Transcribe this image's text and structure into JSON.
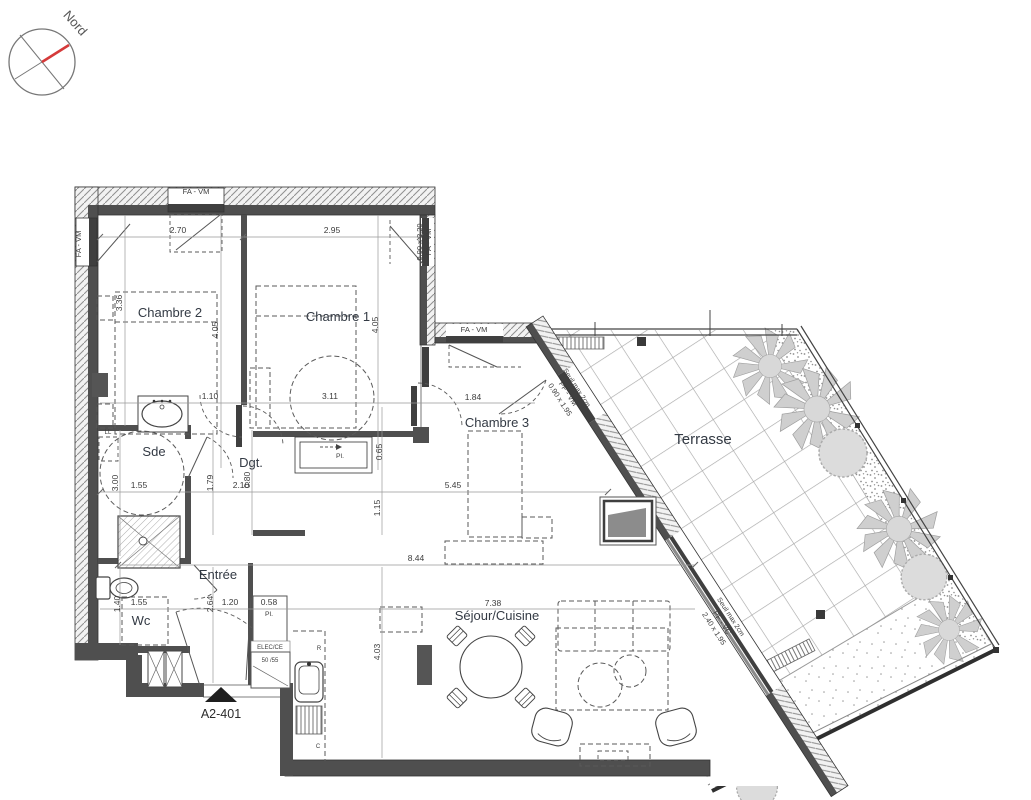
{
  "plan": {
    "code": "A2-401",
    "compass_label": "Nord",
    "rooms": [
      "Chambre 1",
      "Chambre 2",
      "Chambre 3",
      "Sde",
      "Dgt.",
      "Wc",
      "Entrée",
      "Séjour/Cuisine",
      "Terrasse"
    ]
  },
  "texts": [
    {
      "t": "Nord",
      "x": 72,
      "y": 26,
      "r": 48,
      "cls": "compass",
      "name": "compass-label",
      "anchor": "start"
    },
    {
      "t": "Chambre 2",
      "x": 170,
      "y": 317,
      "cls": "room",
      "name": "room-label-chambre-2"
    },
    {
      "t": "Chambre 1",
      "x": 338,
      "y": 321,
      "cls": "room",
      "name": "room-label-chambre-1"
    },
    {
      "t": "Chambre 3",
      "x": 497,
      "y": 427,
      "cls": "room",
      "name": "room-label-chambre-3"
    },
    {
      "t": "Sde",
      "x": 154,
      "y": 456,
      "cls": "room",
      "name": "room-label-sde"
    },
    {
      "t": "Dgt.",
      "x": 251,
      "y": 467,
      "cls": "room",
      "name": "room-label-dgt"
    },
    {
      "t": "Wc",
      "x": 141,
      "y": 625,
      "cls": "room",
      "name": "room-label-wc"
    },
    {
      "t": "Entrée",
      "x": 218,
      "y": 579,
      "cls": "room",
      "name": "room-label-entree"
    },
    {
      "t": "Séjour/Cuisine",
      "x": 497,
      "y": 620,
      "cls": "room",
      "name": "room-label-sejour-cuisine"
    },
    {
      "t": "Terrasse",
      "x": 703,
      "y": 444,
      "cls": "room-lg",
      "name": "room-label-terrasse"
    },
    {
      "t": "A2-401",
      "x": 221,
      "y": 718,
      "cls": "code",
      "name": "plan-code"
    },
    {
      "t": "FA - VM",
      "x": 196,
      "y": 194,
      "cls": "win",
      "name": "window-label"
    },
    {
      "t": "FA - VM",
      "x": 81,
      "y": 244,
      "r": -90,
      "cls": "win",
      "name": "window-label"
    },
    {
      "t": "0.90 x 2.20",
      "x": 422,
      "y": 242,
      "r": -90,
      "cls": "win",
      "name": "window-size-label"
    },
    {
      "t": "FA - VM",
      "x": 431,
      "y": 242,
      "r": -90,
      "cls": "win",
      "name": "window-label"
    },
    {
      "t": "FA - VM",
      "x": 474,
      "y": 332,
      "cls": "win",
      "name": "window-label"
    },
    {
      "t": "0.90 x 1.95",
      "x": 558,
      "y": 401,
      "r": 57,
      "cls": "win",
      "name": "window-size-label"
    },
    {
      "t": "PF - VM",
      "x": 566,
      "y": 395,
      "r": 57,
      "cls": "win",
      "name": "window-label"
    },
    {
      "t": "Seuil max 2cm",
      "x": 575,
      "y": 389,
      "r": 57,
      "cls": "note",
      "name": "threshold-note"
    },
    {
      "t": "2.40 x 1.95",
      "x": 712,
      "y": 630,
      "r": 57,
      "cls": "win",
      "name": "window-size-label"
    },
    {
      "t": "PF - VC",
      "x": 720,
      "y": 624,
      "r": 57,
      "cls": "win",
      "name": "window-label"
    },
    {
      "t": "Seuil max 2cm",
      "x": 729,
      "y": 618,
      "r": 57,
      "cls": "note",
      "name": "threshold-note"
    },
    {
      "t": "2.70",
      "x": 178,
      "y": 233,
      "cls": "dim",
      "name": "dimension-label"
    },
    {
      "t": "2.95",
      "x": 332,
      "y": 233,
      "cls": "dim",
      "name": "dimension-label"
    },
    {
      "t": "3.36",
      "x": 122,
      "y": 303,
      "r": -90,
      "cls": "dim",
      "name": "dimension-label"
    },
    {
      "t": "4.05",
      "x": 218,
      "y": 330,
      "r": -90,
      "cls": "dim",
      "name": "dimension-label"
    },
    {
      "t": "4.05",
      "x": 378,
      "y": 325,
      "r": -90,
      "cls": "dim",
      "name": "dimension-label"
    },
    {
      "t": "1.10",
      "x": 210,
      "y": 399,
      "cls": "dim",
      "name": "dimension-label"
    },
    {
      "t": "3.11",
      "x": 330,
      "y": 399,
      "cls": "dim",
      "name": "dimension-label"
    },
    {
      "t": "1.84",
      "x": 473,
      "y": 400,
      "cls": "dim",
      "name": "dimension-label"
    },
    {
      "t": "3.00",
      "x": 118,
      "y": 483,
      "r": -90,
      "cls": "dim",
      "name": "dimension-label"
    },
    {
      "t": "1.55",
      "x": 139,
      "y": 488,
      "cls": "dim",
      "name": "dimension-label"
    },
    {
      "t": "1.79",
      "x": 213,
      "y": 483,
      "r": -90,
      "cls": "dim",
      "name": "dimension-label"
    },
    {
      "t": "2.10",
      "x": 241,
      "y": 488,
      "cls": "dim",
      "name": "dimension-label"
    },
    {
      "t": "0.80",
      "x": 250,
      "y": 480,
      "r": -90,
      "cls": "dim",
      "name": "dimension-label"
    },
    {
      "t": "5.45",
      "x": 453,
      "y": 488,
      "cls": "dim",
      "name": "dimension-label"
    },
    {
      "t": "0.65",
      "x": 382,
      "y": 452,
      "r": -90,
      "cls": "dim",
      "name": "dimension-label"
    },
    {
      "t": "1.15",
      "x": 380,
      "y": 508,
      "r": -90,
      "cls": "dim",
      "name": "dimension-label"
    },
    {
      "t": "8.44",
      "x": 416,
      "y": 561,
      "cls": "dim",
      "name": "dimension-label"
    },
    {
      "t": "1.40",
      "x": 120,
      "y": 604,
      "r": -90,
      "cls": "dim",
      "name": "dimension-label"
    },
    {
      "t": "1.55",
      "x": 139,
      "y": 605,
      "cls": "dim",
      "name": "dimension-label"
    },
    {
      "t": "2.64",
      "x": 213,
      "y": 604,
      "r": -90,
      "cls": "dim",
      "name": "dimension-label"
    },
    {
      "t": "1.20",
      "x": 230,
      "y": 605,
      "cls": "dim",
      "name": "dimension-label"
    },
    {
      "t": "0.58",
      "x": 269,
      "y": 605,
      "cls": "dim",
      "name": "dimension-label"
    },
    {
      "t": "7.38",
      "x": 493,
      "y": 606,
      "cls": "dim",
      "name": "dimension-label"
    },
    {
      "t": "4.03",
      "x": 380,
      "y": 652,
      "r": -90,
      "cls": "dim",
      "name": "dimension-label"
    },
    {
      "t": "Pl.",
      "x": 340,
      "y": 458,
      "cls": "note",
      "name": "closet-label"
    },
    {
      "t": "Pl.",
      "x": 269,
      "y": 616,
      "cls": "note",
      "name": "closet-label"
    },
    {
      "t": "LL",
      "x": 108,
      "y": 434,
      "cls": "tiny",
      "name": "washer-label"
    },
    {
      "t": "ELEC/CE",
      "x": 270,
      "y": 649,
      "cls": "tiny",
      "name": "elec-label"
    },
    {
      "t": "50 /55",
      "x": 270,
      "y": 662,
      "cls": "tiny",
      "name": "water-heater-label"
    },
    {
      "t": "R",
      "x": 319,
      "y": 650,
      "cls": "tiny",
      "name": "fridge-label"
    },
    {
      "t": "C",
      "x": 318,
      "y": 748,
      "cls": "tiny",
      "name": "cooker-label"
    }
  ]
}
